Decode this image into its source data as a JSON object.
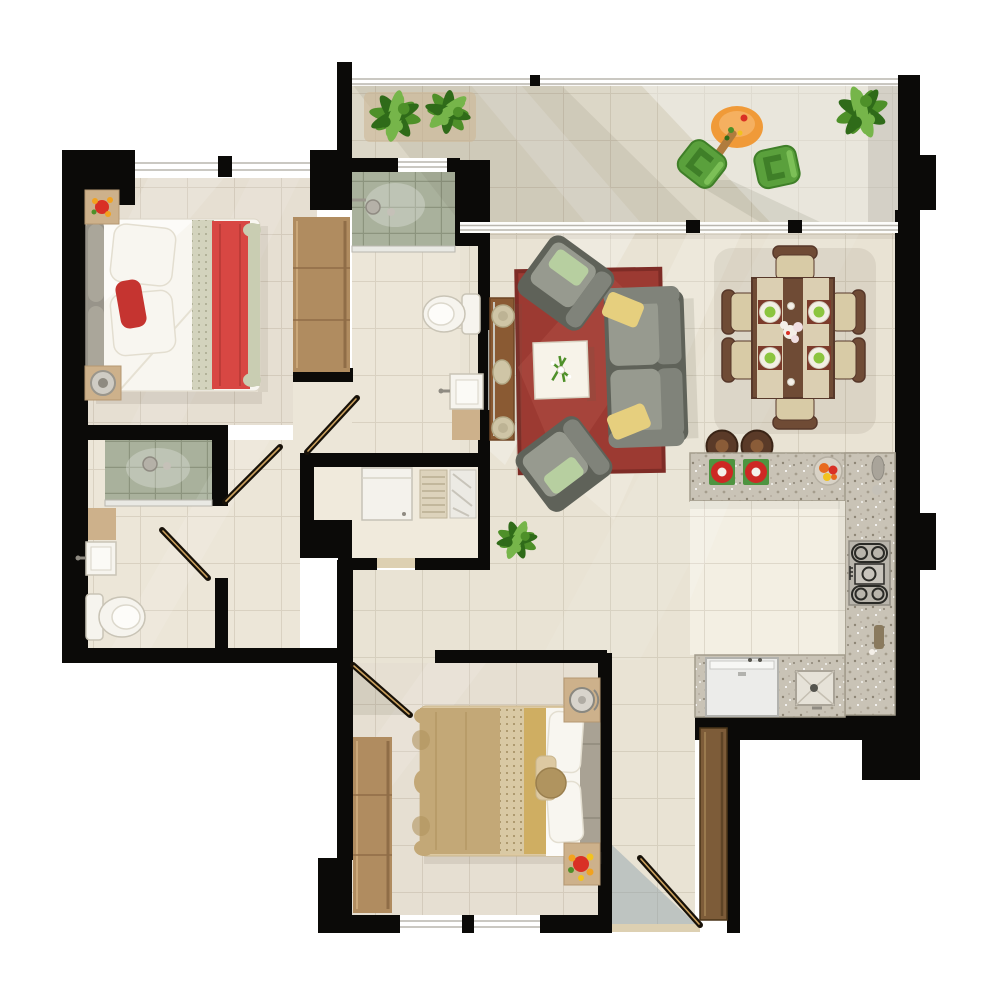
{
  "meta": {
    "title": "Apartment Floor Plan",
    "type": "floor-plan-3d-top-view",
    "canvas_width": 1000,
    "canvas_height": 1000
  },
  "rooms": [
    {
      "id": "master-bedroom",
      "items": [
        "double-bed",
        "white-duvet",
        "red-throw",
        "red-accent-pillow",
        "pillows",
        "headboard",
        "nightstand-with-flowers",
        "nightstand-with-lamp",
        "wardrobe"
      ]
    },
    {
      "id": "ensuite-bathroom",
      "items": [
        "glass-shower",
        "toilet",
        "sink",
        "vanity"
      ]
    },
    {
      "id": "bathroom",
      "items": [
        "glass-shower",
        "toilet",
        "sink",
        "wood-shelf"
      ]
    },
    {
      "id": "hallway",
      "items": [
        "door-leaf",
        "door-leaf",
        "door-leaf"
      ]
    },
    {
      "id": "laundry-closet",
      "items": [
        "washing-machine",
        "drying-rack",
        "ironing-board"
      ]
    },
    {
      "id": "living-room",
      "items": [
        "red-area-rug",
        "sofa-with-yellow-pillows",
        "armchair-with-green-pillow",
        "armchair-with-green-pillow",
        "white-coffee-table",
        "table-plant",
        "console-table",
        "decorative-plates",
        "floor-plant"
      ]
    },
    {
      "id": "dining-area",
      "items": [
        "dining-table",
        "table-runners",
        "place-setting",
        "place-setting",
        "place-setting",
        "place-setting",
        "center-flowers",
        "dining-chair",
        "dining-chair",
        "dining-chair",
        "dining-chair",
        "dining-chair",
        "dining-chair",
        "bar-stool",
        "bar-stool"
      ]
    },
    {
      "id": "kitchen",
      "items": [
        "l-shaped-granite-counter",
        "gas-stove",
        "refrigerator",
        "kitchen-sink",
        "fruit-bowl",
        "red-serving-bowl",
        "red-serving-bowl",
        "countertop-accessories"
      ]
    },
    {
      "id": "second-bedroom",
      "items": [
        "double-bed",
        "tan-duvet",
        "gold-band",
        "pillows",
        "headboard-bench",
        "nightstand-with-lamp",
        "nightstand-with-flowers",
        "wardrobe"
      ]
    },
    {
      "id": "balcony",
      "items": [
        "railing",
        "potted-plant",
        "potted-plant",
        "potted-plant",
        "orange-patio-table",
        "green-patio-chair",
        "green-patio-chair",
        "sliding-glass-door"
      ]
    },
    {
      "id": "entry",
      "items": [
        "entry-door",
        "door-swing",
        "threshold"
      ]
    }
  ],
  "colors": {
    "wall": "#0b0a08",
    "floor_main": "#e9e3d4",
    "floor_bedroom": "#e6dfd2",
    "floor_hall": "#ece6d8",
    "floor_balcony": "#dcd7c7",
    "floor_kitchen": "#f3efe3",
    "floor_closet": "#f0eadc",
    "tile_shower": "#a9b19c",
    "tile_line": "#8c947e",
    "grid_line": "#8c7e62",
    "granite": "#c9c3b6",
    "granite_edge": "#a39c8c",
    "rug": "#9c3a32",
    "rug_light": "#b35148",
    "rug_dark": "#7e2c26",
    "sofa": "#80837a",
    "sofa_dark": "#5f6259",
    "sofa_light": "#979a8f",
    "pillow_yellow": "#e6cf7e",
    "pillow_green": "#b7cfa0",
    "table_white": "#f7f3e9",
    "console_wood": "#8a5a33",
    "plate_beige": "#cfc5a6",
    "dining_wood": "#6f4b35",
    "dining_wood_dark": "#57382a",
    "runner": "#dbcfb2",
    "chair_seat": "#d8cba6",
    "mat_maroon": "#7c3b2b",
    "plate_white": "#f2efe4",
    "plate_green": "#8bc53f",
    "stool": "#5a3a28",
    "stool_dark": "#3a2416",
    "fridge": "#ececea",
    "steel": "#b9b5ac",
    "burner": "#2a2a26",
    "bowl_red": "#cd2824",
    "mat_green": "#4e9440",
    "fruit_bowl": "#d8d2c6",
    "fruit_orange": "#e86a1e",
    "fixture": "#f6f4ee",
    "fixture_edge": "#c9c4b6",
    "bed_white": "#f8f6f0",
    "bed_red": "#d84743",
    "red_pillow": "#c53430",
    "bed_pattern": "#d3d3bd",
    "bed_sage": "#c9cdb2",
    "headboard": "#98948a",
    "headboard_light": "#aaa69a",
    "nightstand": "#cdb18b",
    "bed_tan": "#c3a877",
    "bed_tan_dark": "#b0945f",
    "bed_gold": "#cfae62",
    "bed_cream": "#ddc9a2",
    "bench_gray": "#a9a294",
    "wardrobe": "#b08c60",
    "wardrobe_dark": "#8f6d47",
    "plant": "#4e9029",
    "plant_dark": "#2f6b19",
    "plant_light": "#76b54a",
    "pot": "#a9885e",
    "patio_chair": "#5aa03c",
    "patio_chair_dark": "#3f7f28",
    "patio_table": "#f09a38",
    "door_wood": "#7d5c39",
    "door_line": "#171108",
    "door_gold": "#caa05e",
    "glass": "#b9b6ae",
    "shadow": "#5f5948",
    "sun": "#ffffff",
    "entry_glass": "#8399a8",
    "threshold": "#ddd0b2"
  }
}
